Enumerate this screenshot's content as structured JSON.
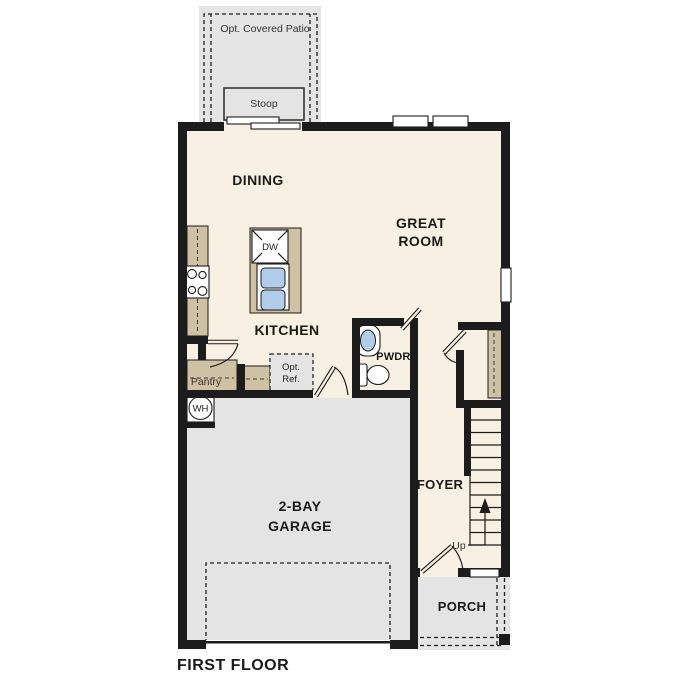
{
  "plan_title": "FIRST FLOOR",
  "rooms": {
    "dining": "DINING",
    "great_room": [
      "GREAT",
      "ROOM"
    ],
    "kitchen": "KITCHEN",
    "powder": "PWDR.",
    "pantry": "Pantry",
    "foyer": "FOYER",
    "garage": [
      "2-BAY",
      "GARAGE"
    ],
    "porch": "PORCH",
    "stoop": "Stoop",
    "patio": "Opt. Covered Patio"
  },
  "fixtures": {
    "dishwasher": "DW",
    "water_heater": "WH",
    "opt_fridge": [
      "Opt.",
      "Ref."
    ],
    "stairs_direction": "Up"
  },
  "colors": {
    "wall": "#1c1c1c",
    "interior": "#f8f0e2",
    "casework": "#cfc2a4",
    "concrete": "#e4e4e4",
    "fixture_blue": "#b2cde9",
    "background": "#ffffff"
  }
}
